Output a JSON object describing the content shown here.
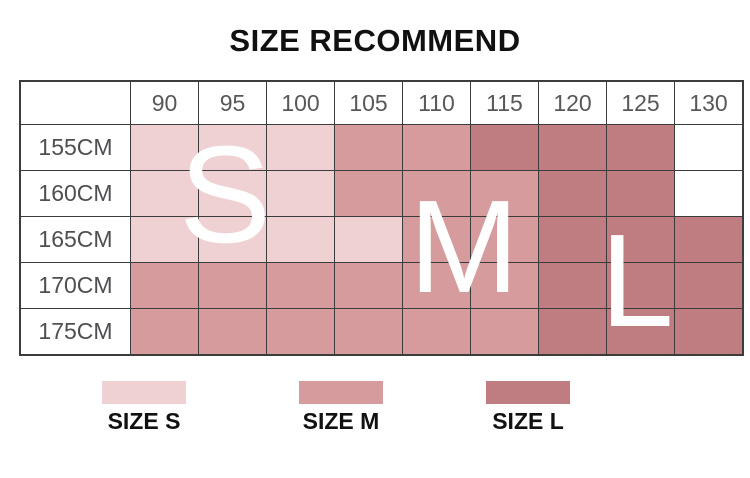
{
  "title": "SIZE RECOMMEND",
  "colors": {
    "S": "#F0D1D3",
    "M": "#D59B9D",
    "L": "#C07D81",
    "empty": "#FFFFFF",
    "grid_line": "#3C3C3C",
    "header_text": "#58585A",
    "overlay_letter_text": "#FFFFFF"
  },
  "table": {
    "corner_label": "",
    "columns": [
      "90",
      "95",
      "100",
      "105",
      "110",
      "115",
      "120",
      "125",
      "130"
    ],
    "rows": [
      {
        "label": "155CM",
        "cells": [
          "S",
          "S",
          "S",
          "M",
          "M",
          "L",
          "L",
          "L",
          ""
        ]
      },
      {
        "label": "160CM",
        "cells": [
          "S",
          "S",
          "S",
          "M",
          "M",
          "M",
          "L",
          "L",
          ""
        ]
      },
      {
        "label": "165CM",
        "cells": [
          "S",
          "S",
          "S",
          "S",
          "M",
          "M",
          "L",
          "L",
          "L"
        ]
      },
      {
        "label": "170CM",
        "cells": [
          "M",
          "M",
          "M",
          "M",
          "M",
          "M",
          "L",
          "L",
          "L"
        ]
      },
      {
        "label": "175CM",
        "cells": [
          "M",
          "M",
          "M",
          "M",
          "M",
          "M",
          "L",
          "L",
          "L"
        ]
      }
    ]
  },
  "overlay_letters": [
    {
      "text": "S"
    },
    {
      "text": "M"
    },
    {
      "text": "L"
    }
  ],
  "legend": [
    {
      "label": "SIZE S",
      "color": "#F0D1D3"
    },
    {
      "label": "SIZE M",
      "color": "#D59B9D"
    },
    {
      "label": "SIZE L",
      "color": "#C07D81"
    }
  ],
  "chart_data": {
    "type": "heatmap",
    "title": "SIZE RECOMMEND",
    "x_categories": [
      "90",
      "95",
      "100",
      "105",
      "110",
      "115",
      "120",
      "125",
      "130"
    ],
    "y_categories": [
      "155CM",
      "160CM",
      "165CM",
      "170CM",
      "175CM"
    ],
    "cell_values": [
      [
        "S",
        "S",
        "S",
        "M",
        "M",
        "L",
        "L",
        "L",
        null
      ],
      [
        "S",
        "S",
        "S",
        "M",
        "M",
        "M",
        "L",
        "L",
        null
      ],
      [
        "S",
        "S",
        "S",
        "S",
        "M",
        "M",
        "L",
        "L",
        "L"
      ],
      [
        "M",
        "M",
        "M",
        "M",
        "M",
        "M",
        "L",
        "L",
        "L"
      ],
      [
        "M",
        "M",
        "M",
        "M",
        "M",
        "M",
        "L",
        "L",
        "L"
      ]
    ],
    "legend_entries": [
      "SIZE S",
      "SIZE M",
      "SIZE L"
    ],
    "legend_position": "bottom",
    "grid": true
  }
}
